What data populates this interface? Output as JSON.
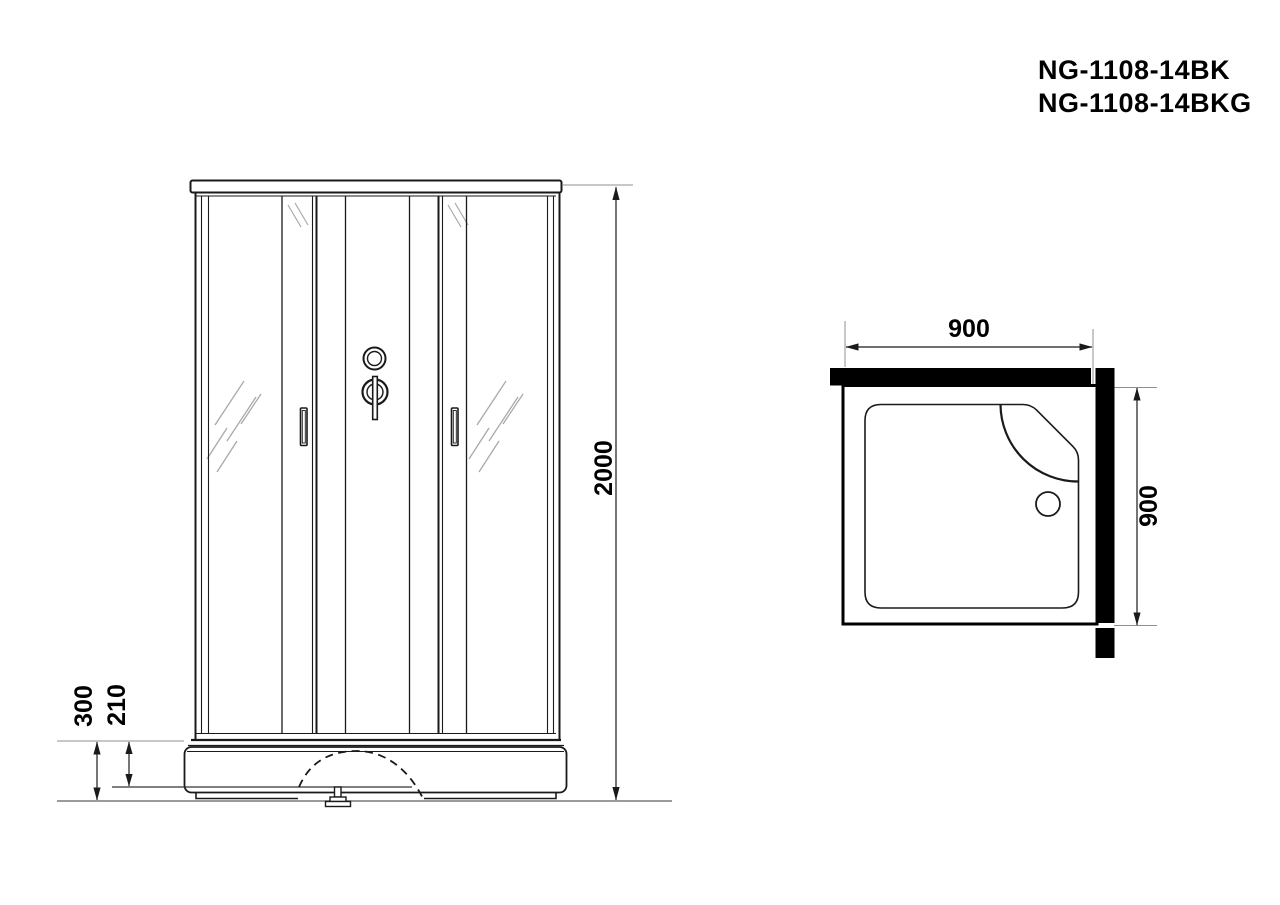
{
  "title": {
    "line1": "NG-1108-14BK",
    "line2": "NG-1108-14BKG"
  },
  "front_view": {
    "name": "front-elevation",
    "dim_height": "2000",
    "dim_base_height": "300",
    "dim_base_inner": "210"
  },
  "top_view": {
    "name": "plan-view",
    "dim_width": "900",
    "dim_depth": "900"
  },
  "colors": {
    "line": "#1a1a1a",
    "guide": "#909090",
    "floor": "#9a9a9a",
    "hatch": "#a9a9a9",
    "wall_fill": "#000000",
    "background": "#ffffff"
  }
}
